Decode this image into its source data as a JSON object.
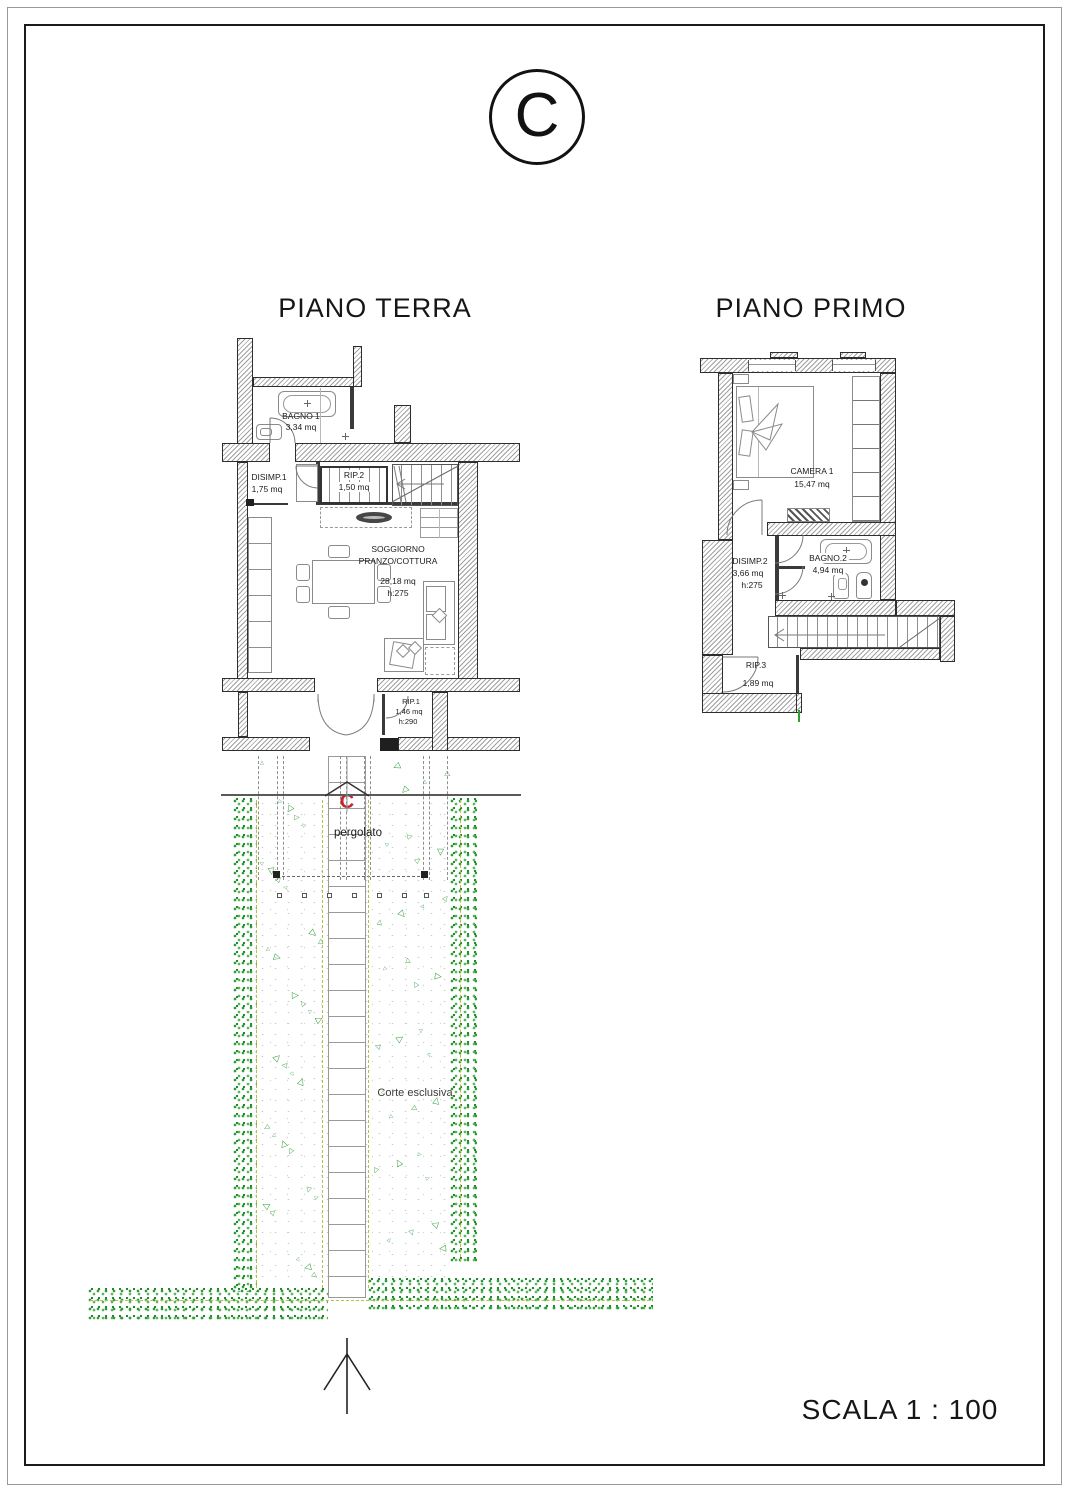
{
  "sheet": {
    "section_circle_letter": "C"
  },
  "titles": {
    "ground": "PIANO TERRA",
    "first": "PIANO PRIMO"
  },
  "ground_floor": {
    "bagno1_name": "BAGNO 1",
    "bagno1_area": "3,34 mq",
    "disimp1_name": "DISIMP.1",
    "disimp1_area": "1,75 mq",
    "rip2_name": "RIP.2",
    "rip2_area": "1,50 mq",
    "soggiorno_name": "SOGGIORNO",
    "soggiorno_name2": "PRANZO/COTTURA",
    "soggiorno_area": "28,18 mq",
    "soggiorno_height": "h:275",
    "rip1_name": "RIP.1",
    "rip1_area": "1,46 mq",
    "rip1_height": "h:290"
  },
  "first_floor": {
    "camera1_name": "CAMERA 1",
    "camera1_area": "15,47 mq",
    "disimp2_name": "DISIMP.2",
    "disimp2_area": "3,66 mq",
    "disimp2_height": "h:275",
    "bagno2_name": "BAGNO.2",
    "bagno2_area": "4,94 mq",
    "rip3_name": "RIP.3",
    "rip3_area": "1,89 mq"
  },
  "site": {
    "section_letter": "C",
    "pergola_label": "pergolato",
    "courtyard_label": "Corte esclusiva"
  },
  "footer": {
    "scale_label": "SCALA 1 : 100"
  },
  "colors": {
    "hedge_green": "#2e9d35",
    "marker_red": "#c1272d",
    "hatch_gray": "#a0a0a0",
    "ink": "#1c1c1c"
  }
}
